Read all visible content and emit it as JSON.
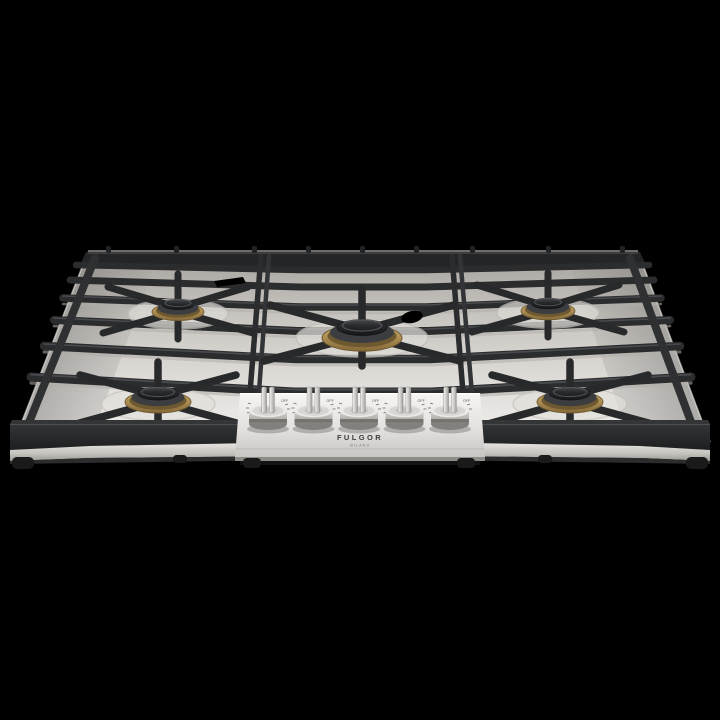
{
  "scene": {
    "description": "Product photo of a five-burner stainless steel gas cooktop with black cast-iron grates and brass burners, front perspective view on a black background",
    "background_color": "#000000"
  },
  "brand": {
    "name": "FULGOR",
    "sub_name": "MILANO"
  },
  "cooktop": {
    "material": "stainless steel",
    "colors": {
      "steel_light": "#eceae7",
      "steel_mid": "#cfccc7",
      "steel_dark": "#a19e99",
      "grate": "#2d2e30",
      "grate_highlight": "#4a4c4f",
      "brass": "#b1945c",
      "brass_dark": "#7c6236",
      "burner_cap": "#202124"
    },
    "burners": [
      {
        "id": "back-left",
        "size": "medium"
      },
      {
        "id": "front-left",
        "size": "large"
      },
      {
        "id": "center",
        "size": "extra-large"
      },
      {
        "id": "back-right",
        "size": "medium"
      },
      {
        "id": "front-right",
        "size": "large"
      }
    ]
  },
  "control_panel": {
    "knobs": [
      {
        "id": "knob-1",
        "marking": "OFF"
      },
      {
        "id": "knob-2",
        "marking": "OFF"
      },
      {
        "id": "knob-3",
        "marking": "OFF"
      },
      {
        "id": "knob-4",
        "marking": "OFF"
      },
      {
        "id": "knob-5",
        "marking": "OFF"
      }
    ]
  }
}
